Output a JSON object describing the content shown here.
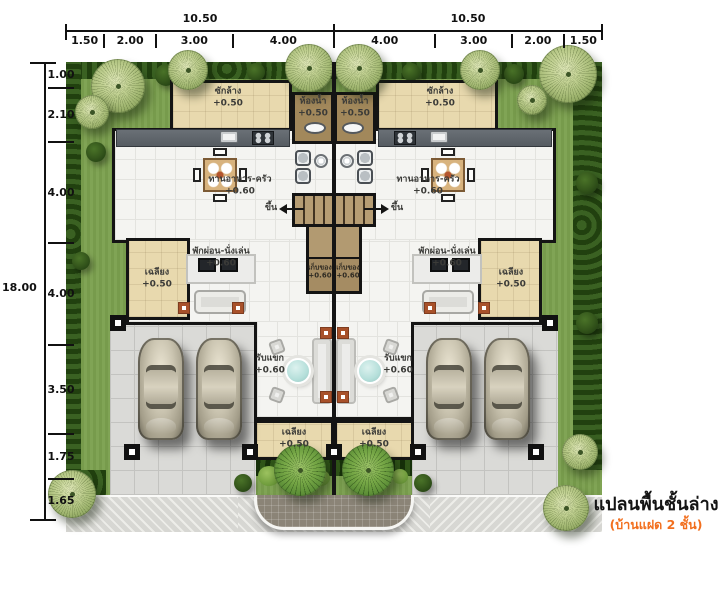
{
  "title": {
    "main": "แปลนพื้นชั้นล่าง",
    "sub": "(บ้านแฝด 2 ชั้น)"
  },
  "dimensions": {
    "top_totals": [
      "10.50",
      "10.50"
    ],
    "top_segments": [
      "1.50",
      "2.00",
      "3.00",
      "4.00",
      "4.00",
      "3.00",
      "2.00",
      "1.50"
    ],
    "left_total": "18.00",
    "left_segments": [
      "1.00",
      "2.10",
      "4.00",
      "4.00",
      "3.50",
      "1.75",
      "1.65"
    ]
  },
  "rooms": {
    "left": {
      "laundry": {
        "label": "ซักล้าง",
        "level": "+0.50"
      },
      "bathroom": {
        "label": "ห้องน้ำ",
        "level": "+0.50"
      },
      "dining_kitchen": {
        "label": "ทานอาหาร-ครัว",
        "level": "+0.60"
      },
      "living": {
        "label": "พักผ่อน-นั่งเล่น",
        "level": "+0.60"
      },
      "side_porch": {
        "label": "เฉลียง",
        "level": "+0.50"
      },
      "reception": {
        "label": "รับแขก",
        "level": "+0.60"
      },
      "front_porch": {
        "label": "เฉลียง",
        "level": "+0.50"
      },
      "storage": {
        "label": "เก็บของ",
        "level": "+0.60"
      },
      "stair": {
        "label": "ขึ้น"
      }
    },
    "right": {
      "laundry": {
        "label": "ซักล้าง",
        "level": "+0.50"
      },
      "bathroom": {
        "label": "ห้องน้ำ",
        "level": "+0.50"
      },
      "dining_kitchen": {
        "label": "ทานอาหาร-ครัว",
        "level": "+0.60"
      },
      "living": {
        "label": "พักผ่อน-นั่งเล่น",
        "level": "+0.60"
      },
      "side_porch": {
        "label": "เฉลียง",
        "level": "+0.50"
      },
      "reception": {
        "label": "รับแขก",
        "level": "+0.60"
      },
      "front_porch": {
        "label": "เฉลียง",
        "level": "+0.50"
      },
      "storage": {
        "label": "เก็บของ",
        "level": "+0.60"
      },
      "stair": {
        "label": "ขึ้น"
      }
    }
  },
  "colors": {
    "grass": "#7ba04e",
    "shrub": "#21400f",
    "room_beige": "#e8d9ae",
    "bath_brown": "#a2885b",
    "stair_tan": "#b29a71",
    "floor": "#f4f4f1",
    "pavement": "#dadad7",
    "counter": "#565c62",
    "wall": "#141414",
    "accent_orange": "#f26f1e",
    "table_teal": "#b5dfda"
  }
}
